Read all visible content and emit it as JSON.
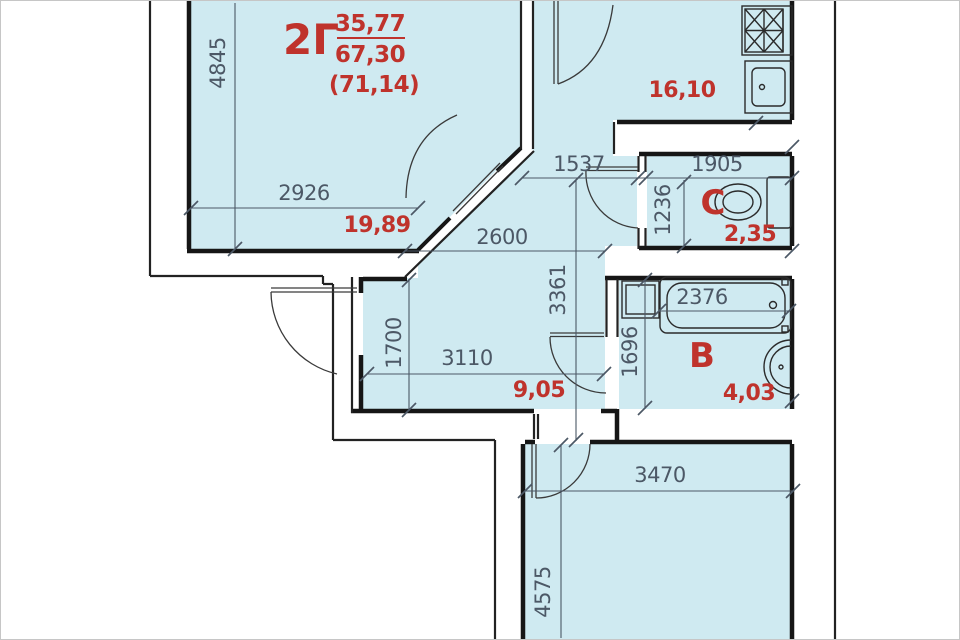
{
  "plan_title": "apartment-floor-plan",
  "apartment": {
    "type_label": "2Г",
    "living_area": "35,77",
    "total_area": "67,30",
    "area_with_balcony": "(71,14)"
  },
  "rooms": {
    "living": {
      "area": "19,89"
    },
    "kitchen": {
      "area": "16,10"
    },
    "wc": {
      "label": "С",
      "area": "2,35"
    },
    "bathroom": {
      "label": "В",
      "area": "4,03"
    },
    "hall": {
      "area": "9,05"
    }
  },
  "dimensions": {
    "d4845": "4845",
    "d2926": "2926",
    "d1537": "1537",
    "d1905": "1905",
    "d1236": "1236",
    "d2600": "2600",
    "d3361": "3361",
    "d1700": "1700",
    "d3110": "3110",
    "d1696": "1696",
    "d2376": "2376",
    "d3470": "3470",
    "d4575": "4575"
  },
  "icons": {
    "stove": "stove-hatch-icon",
    "kitchen_sink": "kitchen-sink-icon",
    "toilet": "toilet-icon",
    "bathtub": "bathtub-icon",
    "washing_machine": "washing-machine-icon",
    "wash_basin": "wash-basin-icon",
    "doors": "door-swing-arc-icon"
  },
  "colors": {
    "room_fill": "#cfeaf1",
    "wall": "#161616",
    "dimension_text": "#4c5866",
    "area_text": "#bf332c",
    "background": "#ffffff"
  }
}
